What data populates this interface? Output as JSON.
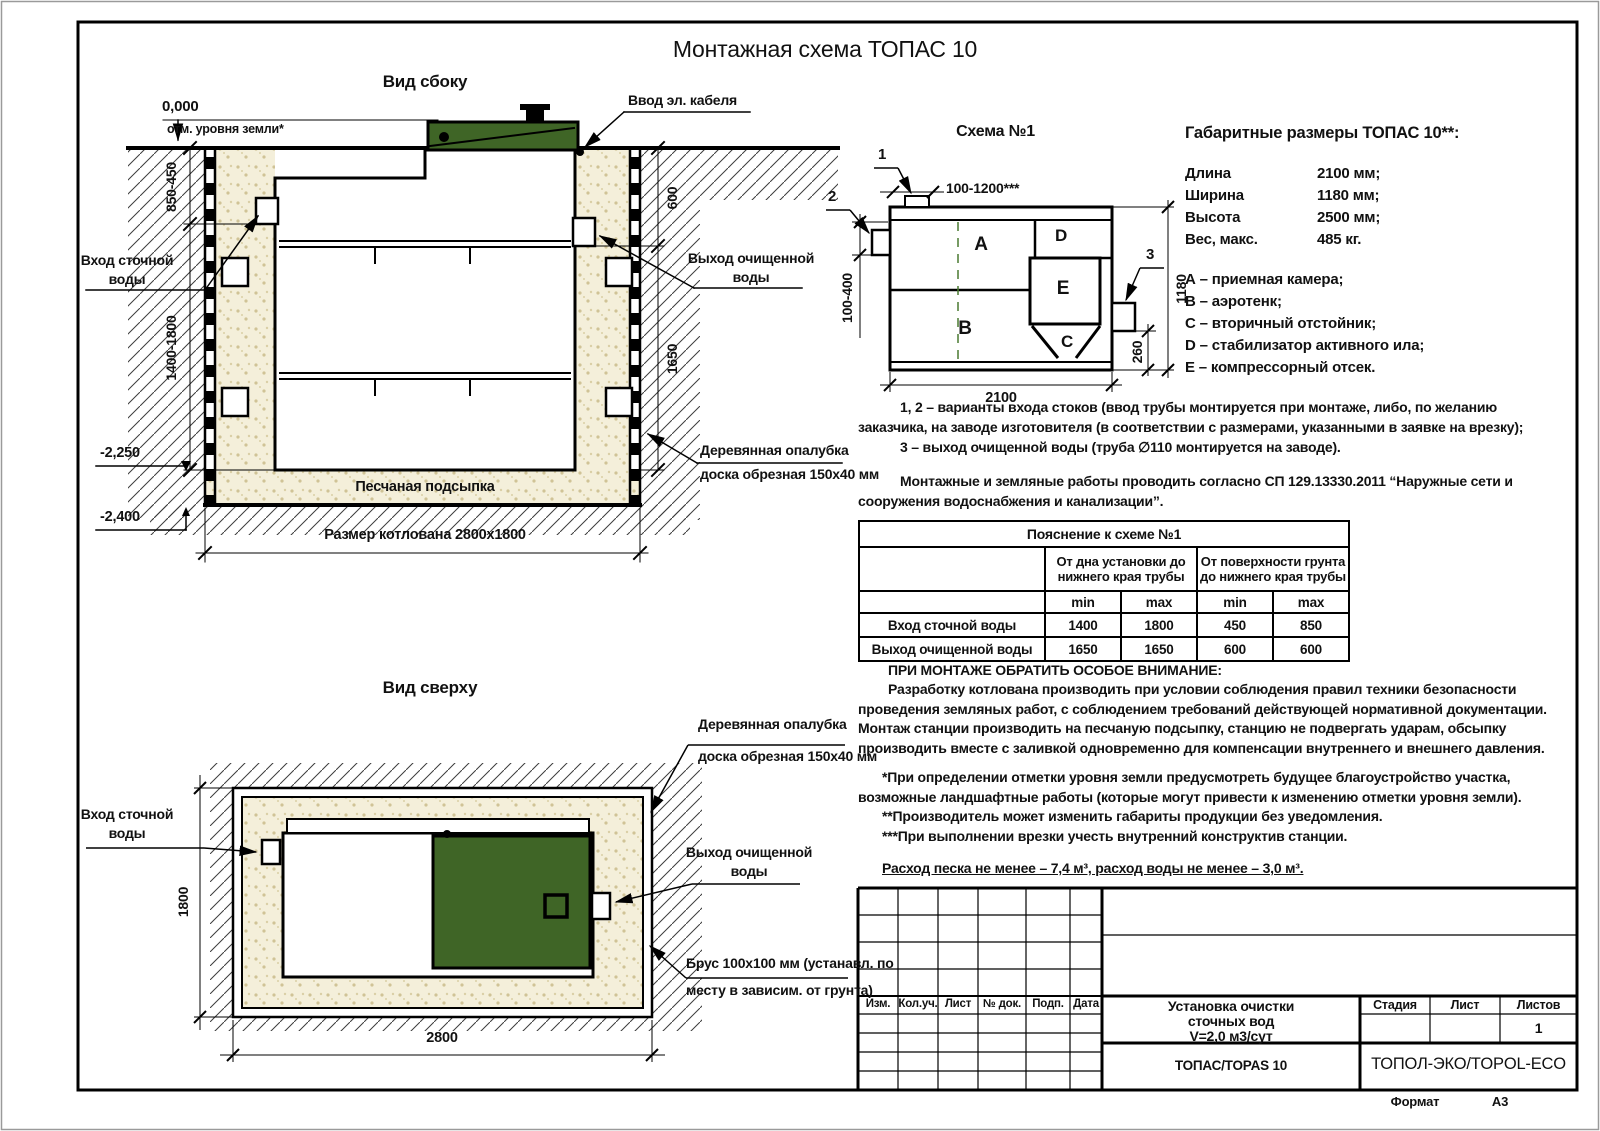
{
  "page": {
    "title": "Монтажная схема ТОПАС 10",
    "format_label": "Формат",
    "format_value": "А3"
  },
  "side_view": {
    "title": "Вид сбоку",
    "zero_mark": "0,000",
    "ground_mark": "отм. уровня земли*",
    "cable_entry": "Ввод эл. кабеля",
    "inlet1": "Вход сточной",
    "inlet2": "воды",
    "outlet1": "Выход очищенной",
    "outlet2": "воды",
    "formwork1": "Деревянная опалубка",
    "formwork2": "доска обрезная 150x40 мм",
    "sand_bedding": "Песчаная подсыпка",
    "pit_size": "Размер котлована 2800x1800",
    "elev1": "-2,250",
    "elev2": "-2,400",
    "d850": "850-450",
    "d1400": "1400-1800",
    "d600": "600",
    "d1650": "1650"
  },
  "top_view": {
    "title": "Вид сверху",
    "formwork1": "Деревянная опалубка",
    "formwork2": "доска обрезная 150x40 мм",
    "inlet1": "Вход сточной",
    "inlet2": "воды",
    "outlet1": "Выход очищенной",
    "outlet2": "воды",
    "beam1": "Брус 100x100 мм (устанавл. по",
    "beam2": "месту в зависим. от грунта)",
    "d1800": "1800",
    "d2800": "2800"
  },
  "schema": {
    "title": "Схема №1",
    "c1": "1",
    "c2": "2",
    "c3": "3",
    "a": "A",
    "b": "B",
    "c": "C",
    "d": "D",
    "e": "E",
    "dtop": "100-1200***",
    "dleft": "100-400",
    "dright": "1180",
    "dsmall": "260",
    "dbottom": "2100"
  },
  "specs": {
    "heading": "Габаритные размеры ТОПАС 10**:",
    "rows": [
      {
        "label": "Длина",
        "value": "2100 мм;"
      },
      {
        "label": "Ширина",
        "value": "1180 мм;"
      },
      {
        "label": "Высота",
        "value": "2500 мм;"
      },
      {
        "label": "Вес, макс.",
        "value": "485 кг."
      }
    ],
    "legend": [
      "А – приемная камера;",
      "В – аэротенк;",
      "С – вторичный отстойник;",
      "D – стабилизатор активного ила;",
      "Е – компрессорный отсек."
    ]
  },
  "notes": {
    "p1a": "1, 2 – варианты входа стоков (ввод трубы монтируется при монтаже, либо, по желанию заказчика, на заводе изготовителя (в соответствии с размерами, указанными в заявке на врезку);",
    "p1b": "3 – выход очищенной воды (труба ∅110 монтируется на заводе).",
    "p2": "Монтажные и земляные работы проводить согласно СП 129.13330.2011 “Наружные сети и сооружения водоснабжения и канализации”."
  },
  "explain_table": {
    "title": "Пояснение к схеме №1",
    "group1": "От дна установки до нижнего края трубы",
    "group2": "От поверхности грунта до нижнего края трубы",
    "min": "min",
    "max": "max",
    "rows": [
      {
        "label": "Вход сточной воды",
        "v": [
          "1400",
          "1800",
          "450",
          "850"
        ]
      },
      {
        "label": "Выход очищенной воды",
        "v": [
          "1650",
          "1650",
          "600",
          "600"
        ]
      }
    ]
  },
  "attention": {
    "heading": "ПРИ МОНТАЖЕ ОБРАТИТЬ ОСОБОЕ ВНИМАНИЕ:",
    "body": "Разработку котлована производить при условии соблюдения правил техники безопасности проведения земляных работ, с соблюдением требований действующей нормативной документации. Монтаж станции производить на песчаную подсыпку, станцию не подвергать ударам, обсыпку производить вместе с заливкой одновременно для компенсации внутреннего и внешнего давления.",
    "note1": "*При определении отметки уровня земли предусмотреть будущее благоустройство участка, возможные ландшафтные работы (которые могут привести к изменению отметки уровня земли).",
    "note2": "**Производитель может изменить габариты продукции без уведомления.",
    "note3": "***При выполнении врезки учесть внутренний конструктив станции.",
    "consumption": "Расход песка не менее – 7,4 м³, расход воды не менее – 3,0 м³."
  },
  "stamp": {
    "cols": [
      "Изм.",
      "Кол.уч.",
      "Лист",
      "№ док.",
      "Подп.",
      "Дата"
    ],
    "title1": "Установка очистки",
    "title2": "сточных вод",
    "title3": "V=2,0 м3/сут",
    "stage": "Стадия",
    "sheet": "Лист",
    "sheets": "Листов",
    "sheets_value": "1",
    "product": "ТОПАС/TOPAS 10",
    "company": "ТОПОЛ-ЭКО/TOPOL-ECO"
  },
  "colors": {
    "lid_green": "#3f6526",
    "sand": "#f4efda",
    "dash_green": "#4a7a30"
  }
}
